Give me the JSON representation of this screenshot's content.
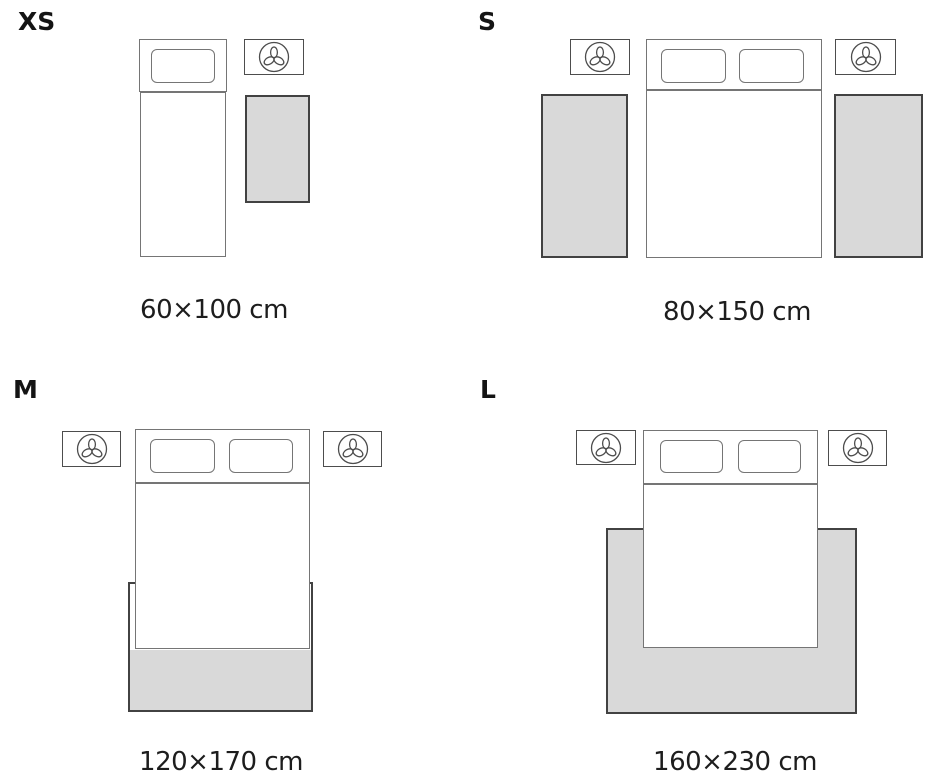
{
  "title": "Rug size guide bedroom layouts",
  "sizes": {
    "xs": {
      "label": "XS",
      "dimensions": "60×100 cm"
    },
    "s": {
      "label": "S",
      "dimensions": "80×150 cm"
    },
    "m": {
      "label": "M",
      "dimensions": "120×170 cm"
    },
    "l": {
      "label": "L",
      "dimensions": "160×230 cm"
    }
  },
  "colors": {
    "background": "#ffffff",
    "rug_fill": "#d9d9d9",
    "rug_border": "#424242",
    "bed_line": "#757575",
    "nightstand_line": "#4d4d4d",
    "text": "#1d1d1d"
  },
  "icons": {
    "nightstand": "lamp-top-view-icon"
  }
}
